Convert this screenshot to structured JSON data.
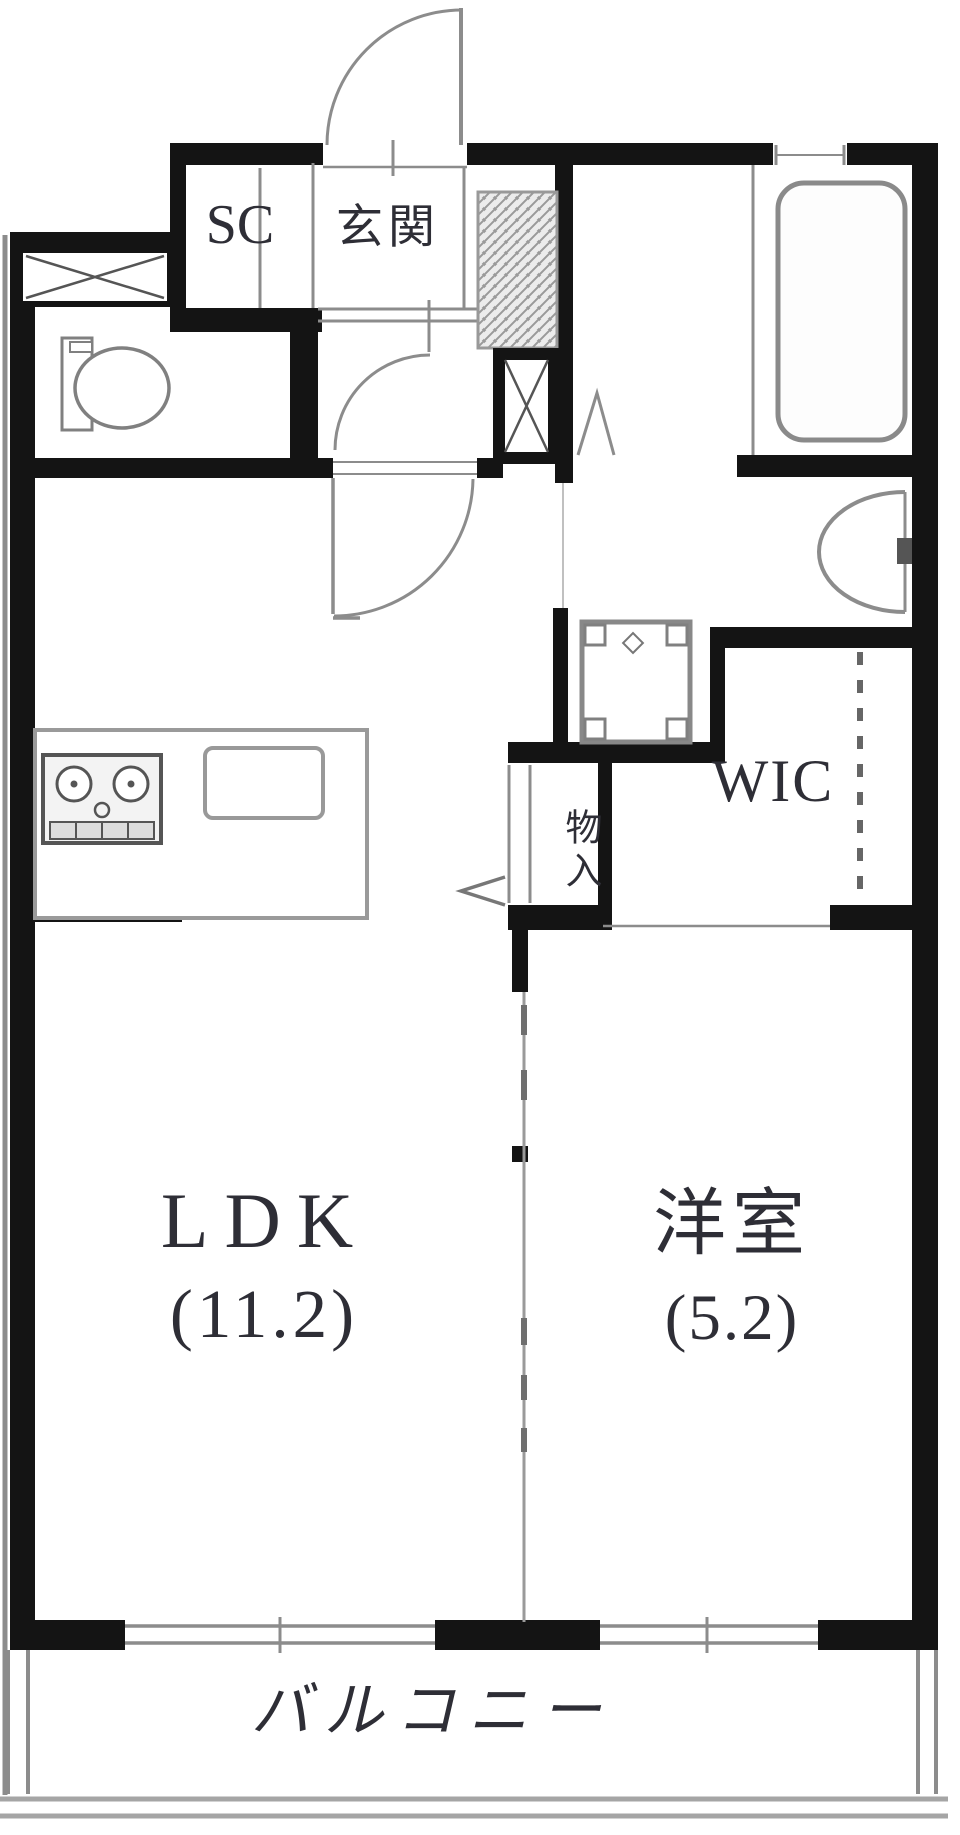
{
  "plan": {
    "labels": {
      "shoe_closet": "SC",
      "entrance": "玄関",
      "walk_in_closet": "WIC",
      "storage": "物入",
      "living_dining_kitchen": "LDK",
      "living_dining_kitchen_size": "(11.2)",
      "western_room": "洋室",
      "western_room_size": "(5.2)",
      "balcony": "バルコニー"
    },
    "colors": {
      "wall": "#141414",
      "line": "#8c8c8c",
      "text": "#2e2e36",
      "background": "#ffffff"
    }
  }
}
